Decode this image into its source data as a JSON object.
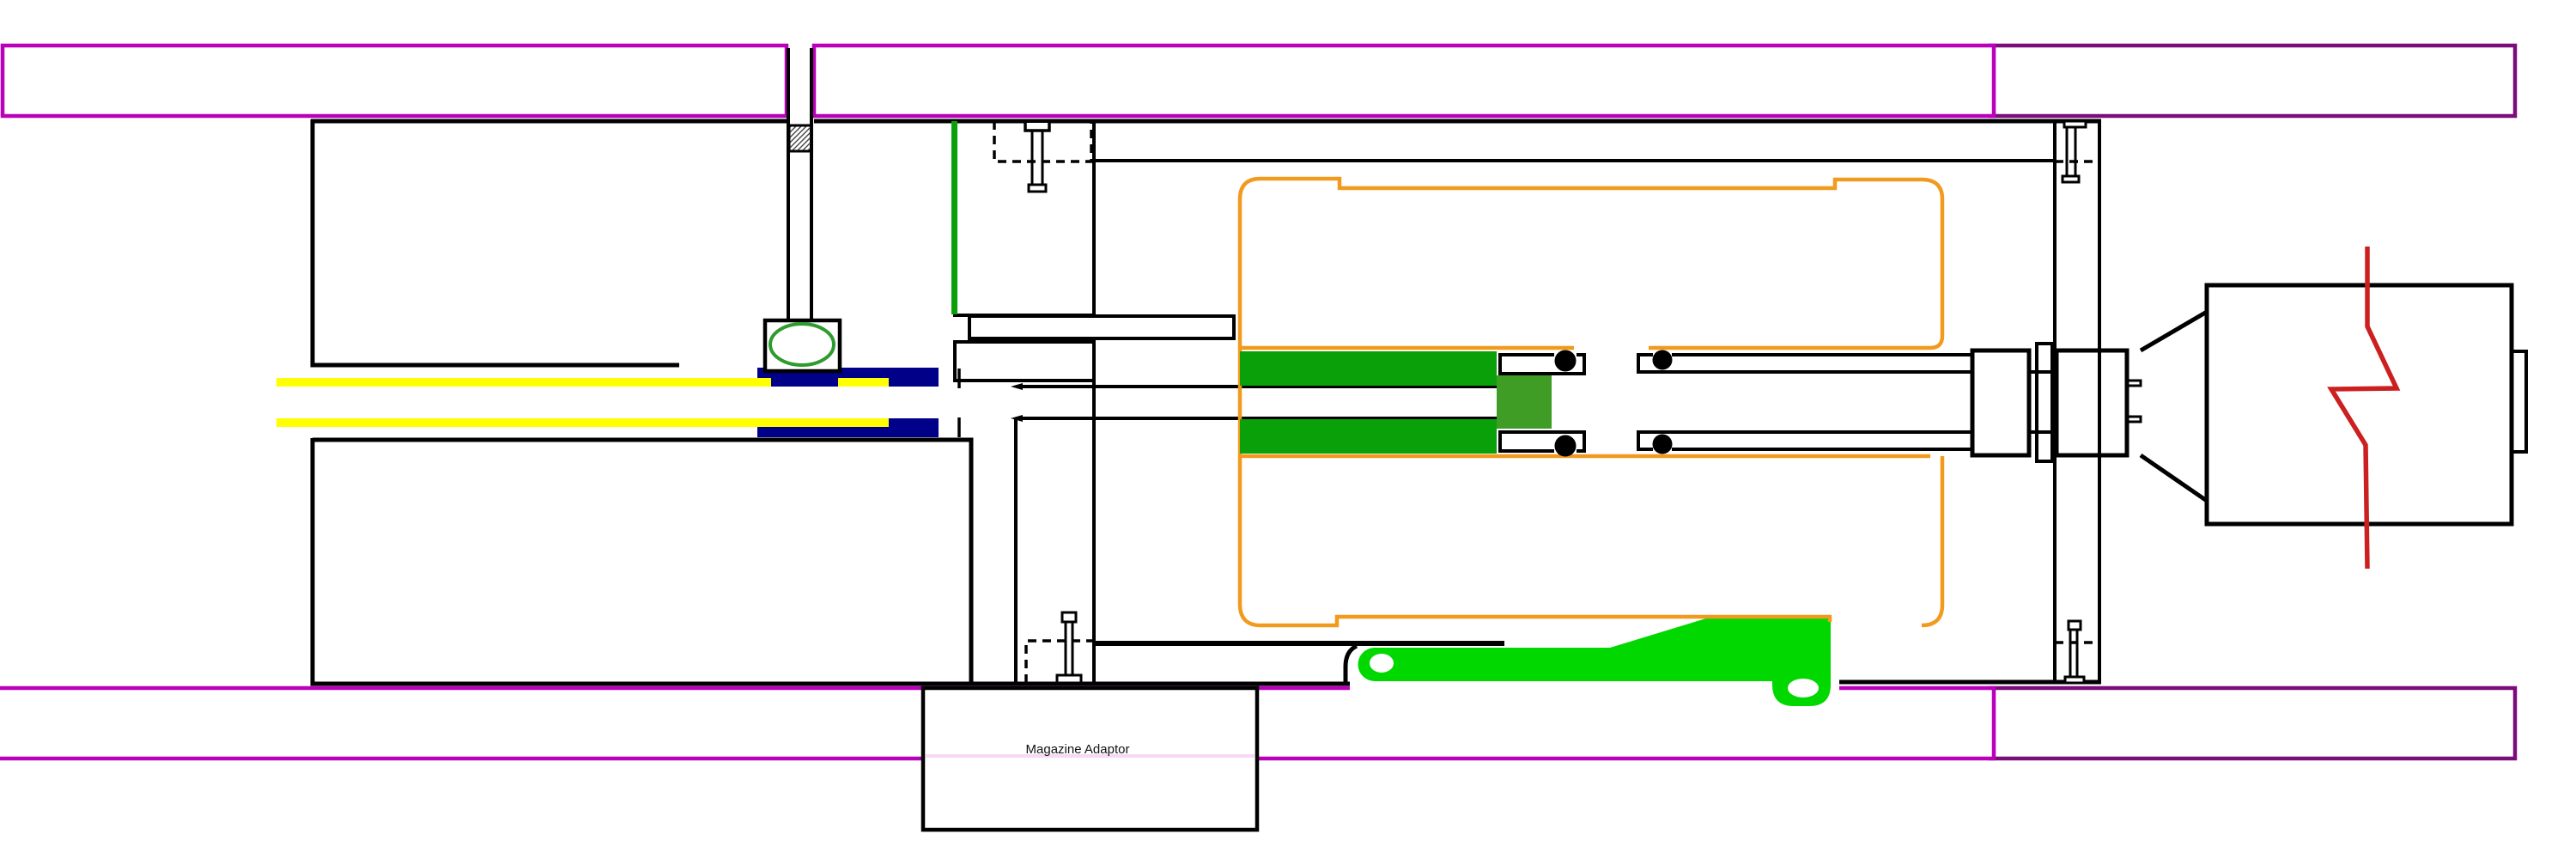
{
  "diagram": {
    "type": "technical-cross-section-drawing",
    "label": "Magazine Adaptor",
    "parts": [
      "outer-housing-band-top",
      "outer-housing-band-bottom",
      "receiver-housing",
      "barrel-sleeve-navy",
      "barrel-rod-yellow",
      "gas-port-block-with-ring",
      "hatched-retaining-pin",
      "gas-tube-orange",
      "piston-green",
      "piston-head-dark-green",
      "o-ring-seal-cups",
      "piston-rod-tube",
      "end-blocks-and-flange",
      "expansion-cone",
      "stock-block",
      "spring-break-symbol-red",
      "cocking-lever-green",
      "magazine-adaptor-box",
      "screws"
    ],
    "colors": {
      "outline_black": "#000000",
      "band_magenta": "#BB00BB",
      "band_dark_purple": "#7A0D7A",
      "sleeve_navy": "#000088",
      "rod_yellow": "#FFFF00",
      "gas_tube_orange": "#F29A1D",
      "piston_green": "#0AA00A",
      "piston_dark_green": "#3F9D26",
      "lever_green": "#00D800",
      "port_ring_green": "#2E9B2E",
      "spring_red": "#CC2020"
    }
  }
}
